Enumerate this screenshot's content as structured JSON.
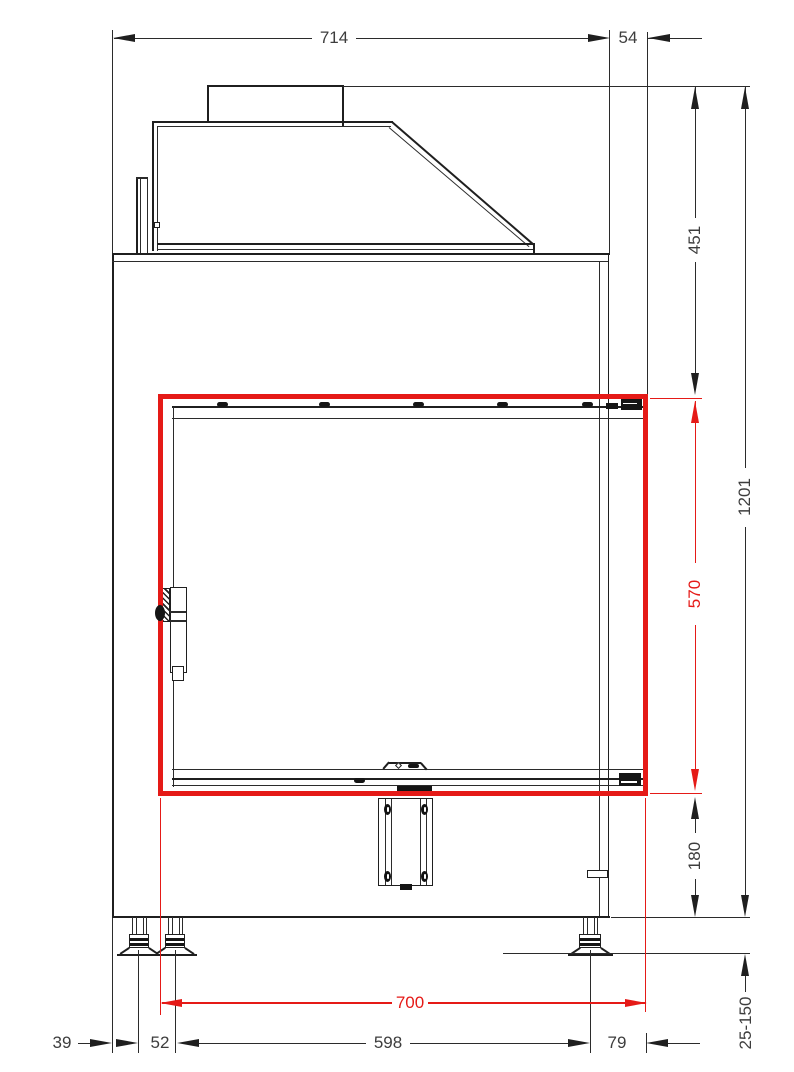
{
  "drawing": {
    "title": "Fireplace insert - front elevation technical drawing",
    "highlight_color": "#e51a17",
    "line_color": "#1f1f1f",
    "dimensions": {
      "overall_width": {
        "value": "714",
        "orientation": "horizontal",
        "color": "black"
      },
      "side_offset": {
        "value": "54",
        "orientation": "horizontal",
        "color": "black"
      },
      "upper_section_height": {
        "value": "451",
        "orientation": "vertical",
        "color": "black"
      },
      "overall_height": {
        "value": "1201",
        "orientation": "vertical",
        "color": "black"
      },
      "glass_height": {
        "value": "570",
        "orientation": "vertical",
        "color": "red"
      },
      "lower_section_height": {
        "value": "180",
        "orientation": "vertical",
        "color": "black"
      },
      "leveling_feet_range": {
        "value": "25-150",
        "orientation": "vertical",
        "color": "black"
      },
      "glass_width": {
        "value": "700",
        "orientation": "horizontal",
        "color": "red"
      },
      "edge_to_first_foot": {
        "value": "39",
        "orientation": "horizontal",
        "color": "black"
      },
      "foot_spacing": {
        "value": "52",
        "orientation": "horizontal",
        "color": "black"
      },
      "feet_span": {
        "value": "598",
        "orientation": "horizontal",
        "color": "black"
      },
      "foot_to_glass_edge": {
        "value": "79",
        "orientation": "horizontal",
        "color": "black"
      }
    },
    "highlight": {
      "description": "glass opening outlined in red",
      "width": "700",
      "height": "570"
    }
  }
}
